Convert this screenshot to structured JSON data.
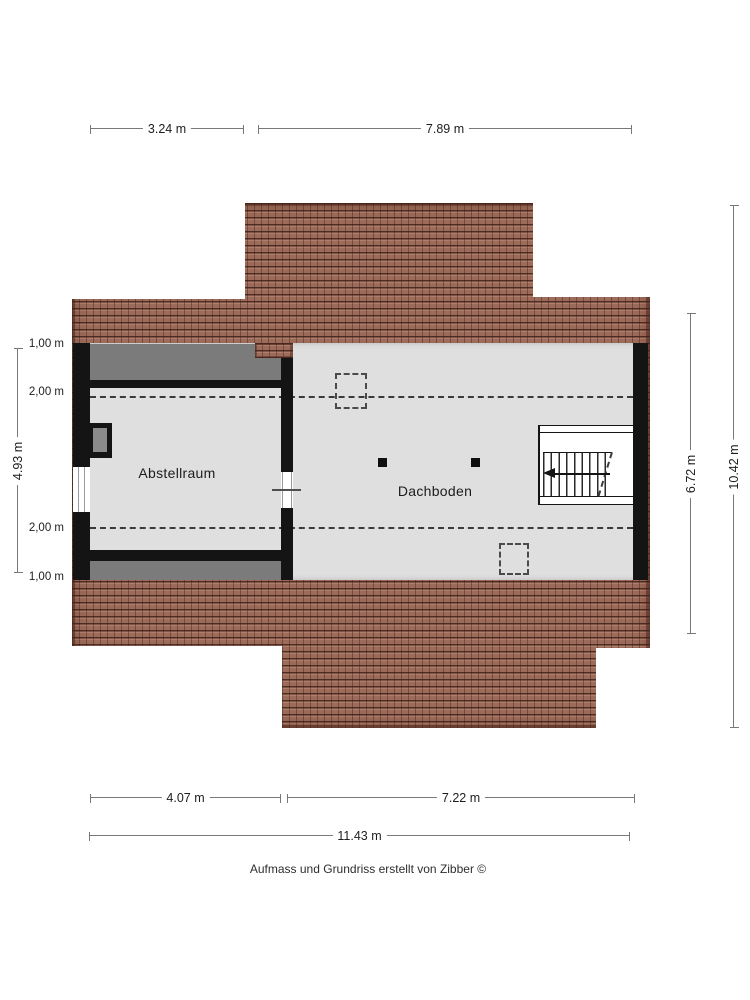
{
  "plan": {
    "rooms": {
      "storage": "Abstellraum",
      "attic": "Dachboden"
    },
    "footer": "Aufmass und Grundriss erstellt von Zibber ©"
  },
  "dimensions": {
    "top": [
      "3.24 m",
      "7.89 m"
    ],
    "bottom": [
      "4.07 m",
      "7.22 m"
    ],
    "bottom_total": "11.43 m",
    "left_total": "4.93 m",
    "left_heights": [
      "1,00 m",
      "2,00 m",
      "2,00 m",
      "1,00 m"
    ],
    "right_inner": "6.72 m",
    "right_total": "10.42 m"
  },
  "colors": {
    "roof": "#a5705c",
    "roof_joint": "#4e2d24",
    "floor": "#dfdfdf",
    "slope_area": "#7b7b7b",
    "wall": "#141414"
  }
}
